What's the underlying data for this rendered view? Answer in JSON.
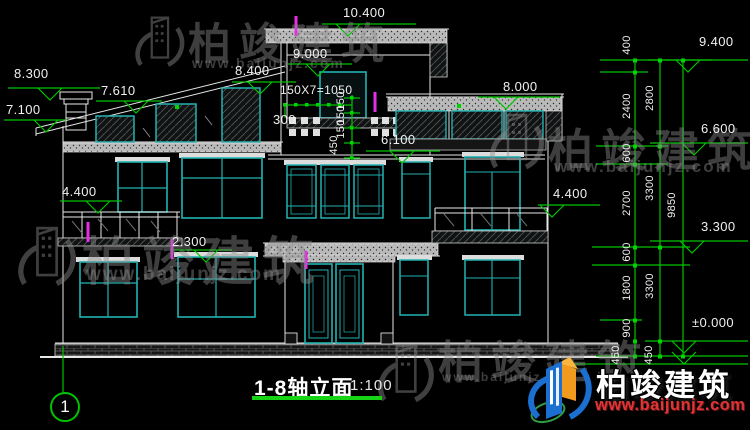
{
  "drawing": {
    "title": "1-8轴立面",
    "scale": "1:100",
    "axis_bubble": "1"
  },
  "levels": {
    "l8300": "8.300",
    "l7610": "7.610",
    "l7100": "7.100",
    "l4400_left": "4.400",
    "l2300": "2.300",
    "l10400": "10.400",
    "l9000": "9.000",
    "l8400": "8.400",
    "l6100": "6.100",
    "l8000": "8.000",
    "l4400_right": "4.400",
    "l9400": "9.400",
    "l6600": "6.600",
    "l3300": "3.300",
    "l0000": "±0.000"
  },
  "dims": {
    "stair": "150X7=1050",
    "step_width": "300",
    "riser_1": "150",
    "riser_2": "150",
    "riser_3": "150",
    "riser_total": "450",
    "chain_inner": [
      "400",
      "2400",
      "600",
      "2700",
      "600",
      "1800",
      "900",
      "450"
    ],
    "chain_mid": [
      "2800",
      "3300",
      "3300",
      "450"
    ],
    "overall": "9850"
  },
  "watermark": {
    "brand": "柏竣建筑",
    "url": "www.baijunjz.com"
  },
  "brand_logo": {
    "name": "柏竣建筑",
    "url": "www.baijunjz.com"
  },
  "colors": {
    "background": "#000000",
    "linework": "#e8e8e8",
    "glazing": "#22b2b2",
    "dimension_green": "#00c400",
    "highlight_magenta": "#e52ee5",
    "title_underline": "#17d417",
    "logo_blue": "#1b6fd0",
    "logo_orange": "#f29a1d",
    "logo_url_red": "#e03535"
  }
}
